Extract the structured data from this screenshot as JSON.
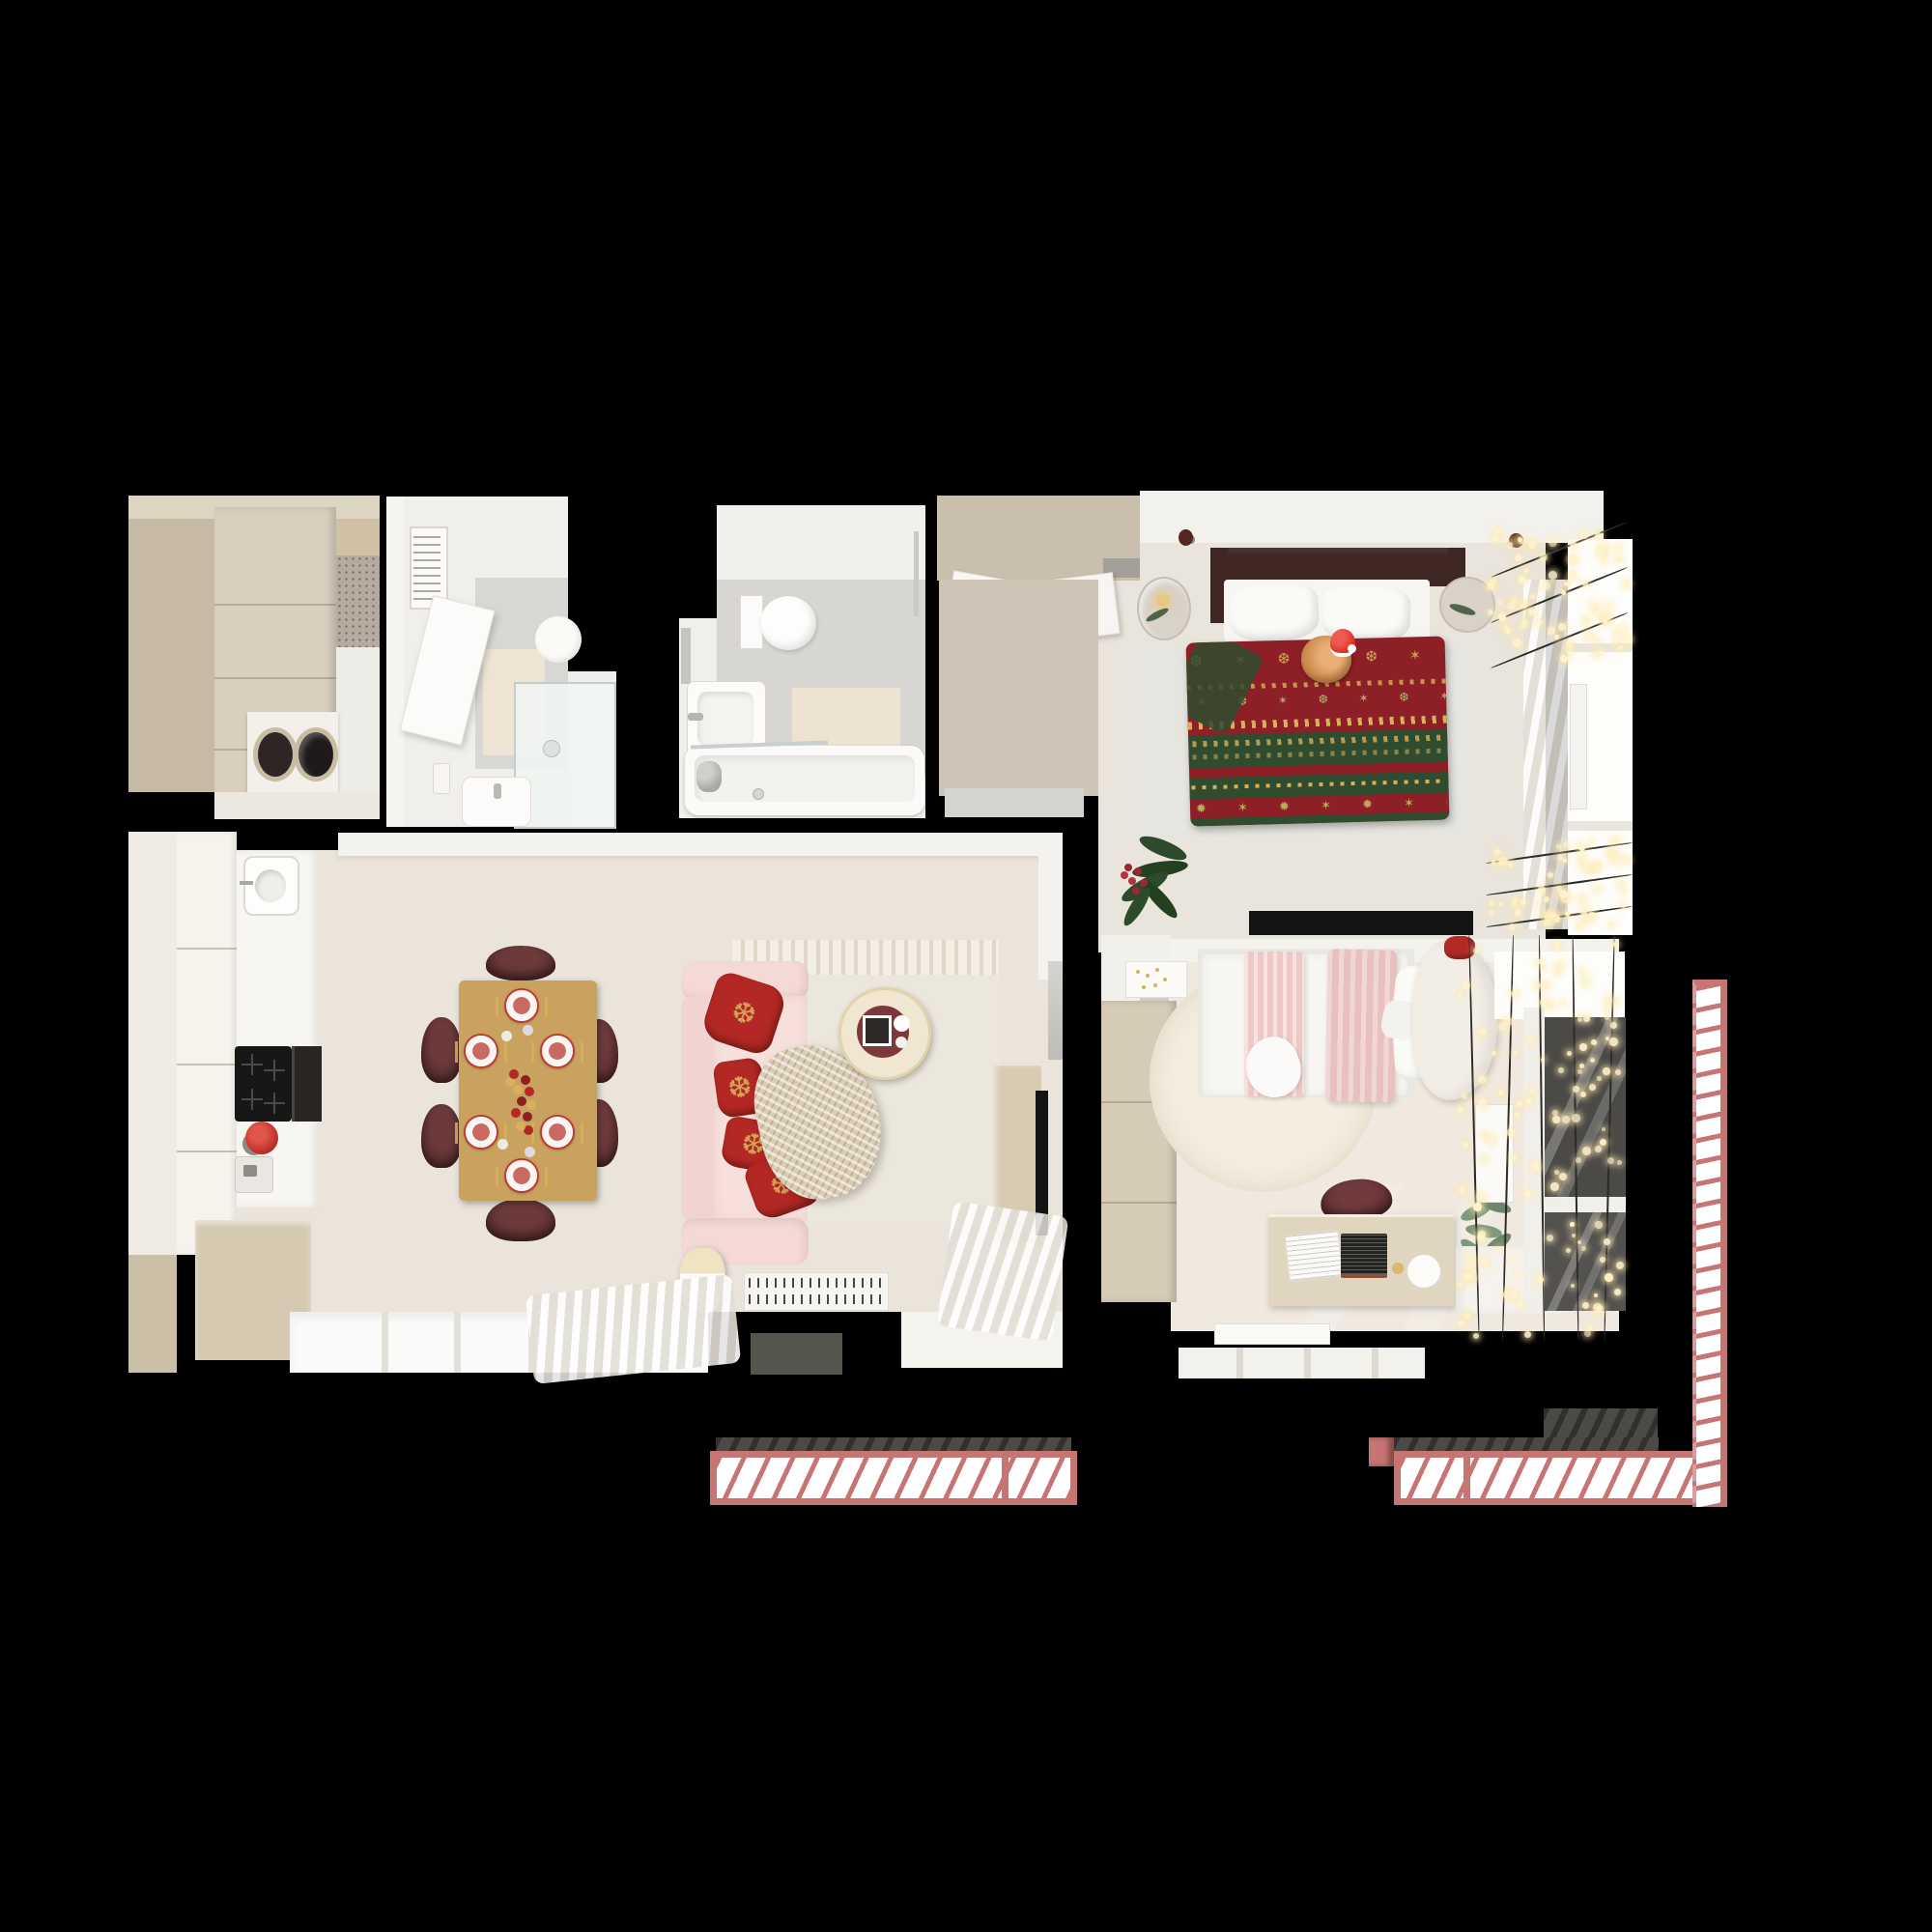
{
  "meta": {
    "description": "Top-down 3D rendered floor plan of a two-bedroom apartment decorated for Christmas",
    "background": "#000000"
  },
  "palette": {
    "bg": "#000000",
    "wood1": "#d2c7b4",
    "wood2": "#c6baa5",
    "wood3": "#dacfbf",
    "woodFloor": "#cfc5b6",
    "woodKBench": "#d5c9b2",
    "woodWardrobe2": "#d6cbb7",
    "woodDesk": "#e0d5bf",
    "woodTV": "#d8cbb2",
    "floorLiving": "#ebe4da",
    "floorBed1": "#e9e4dc",
    "floorBed2": "#f0e9df",
    "wall": "#f4f2ed",
    "white": "#fafaf8",
    "bright": "#fdfdfa",
    "grayTile": "#d8d7d4",
    "grayMat": "#d3d3cf",
    "mosaic": "#b7aba0",
    "matBeige": "#efe4d3",
    "rug1": "#e7e5e0",
    "rug2": "#ece7dc",
    "rug3": "#f4eee1",
    "sofa": "#f4d9d5",
    "sofaLight": "#f7dfdb",
    "pillowRed": "#b32824",
    "gold": "#d8b05a",
    "tableGold": "#c9a25f",
    "chair": "#5c2f30",
    "plateRed": "#c23732",
    "plateFood": "#c96a62",
    "hb": "#3f2823",
    "blkRed": "#8c2026",
    "blkGreen": "#2f4c2f",
    "cat": "#d29052",
    "santa": "#d42b22",
    "glassDark": "#4b4a47",
    "balFloor": "#4b4a47",
    "rail": "#c77573",
    "railDark": "#b55f5f",
    "bulb": "#fff3cf",
    "wire": "#2b2a26",
    "plant1": "#2d4a2b",
    "plant2": "#7f977b",
    "berry": "#9c2733",
    "tv": "#141414",
    "pink1": "#ecc9c6",
    "pink2": "#e8c0bd",
    "cream": "#f2eee6"
  },
  "rooms": [
    {
      "id": "entry-laundry",
      "label": "Entry hall with wardrobe and stacked laundry machines",
      "furniture": [
        "wardrobe",
        "washing-machine",
        "dryer",
        "mosaic-tile-patch"
      ]
    },
    {
      "id": "bathroom-shower",
      "label": "Bathroom with walk-in shower",
      "furniture": [
        "towel-ladder",
        "open-door",
        "glass-shower-cabin",
        "washbasin",
        "round-mirror",
        "bath-mat"
      ]
    },
    {
      "id": "bathroom-tub",
      "label": "Bathroom with bathtub",
      "furniture": [
        "toilet",
        "washbasin",
        "bathtub",
        "glass-screen",
        "bath-mat",
        "shower-rail",
        "mirror"
      ]
    },
    {
      "id": "bedroom-main",
      "label": "Main bedroom with christmas blanket and sleeping cat",
      "furniture": [
        "sliding-wardrobe",
        "doormat",
        "double-bed",
        "fair-isle-christmas-blanket",
        "cat-in-santa-hat",
        "round-nightstand-left",
        "round-nightstand-right",
        "area-rug",
        "potted-plant",
        "tv-sideboard",
        "ceiling-spotlights",
        "window",
        "roman-blind",
        "string-light-garland-top",
        "string-light-garland-bottom"
      ]
    },
    {
      "id": "living-kitchen",
      "label": "Open living room with kitchen and festive dining table",
      "furniture": [
        "tall-cabinets",
        "kitchen-counter",
        "sink",
        "induction-cooktop",
        "built-in-oven",
        "red-kettle",
        "coffee-machine",
        "wood-bench",
        "dining-table",
        "six-dining-chairs",
        "festive-place-settings",
        "ornament-centerpiece",
        "pink-sofa",
        "red-snowflake-pillows",
        "knit-throw",
        "round-coffee-table",
        "cream-rug",
        "radiator",
        "tv-console",
        "tv",
        "floor-lamp",
        "windows",
        "curtains",
        "balcony-door"
      ]
    },
    {
      "id": "bedroom-second",
      "label": "Second bedroom with pink bed and desk",
      "furniture": [
        "wardrobe",
        "mirror-panel",
        "wall-shelf",
        "single-bed",
        "pink-blankets",
        "curved-headboard",
        "round-fluffy-rug",
        "desk",
        "laptop",
        "open-book",
        "desk-lamp",
        "desk-chair",
        "potted-plant",
        "window-sill",
        "vertical-radiator",
        "bottom-radiator",
        "dark-window",
        "string-light-curtain"
      ]
    }
  ],
  "balconies": [
    {
      "id": "balcony-bottom-left",
      "label": "Balcony with pink striped railing"
    },
    {
      "id": "balcony-bottom-right",
      "label": "Wrap-around balcony with pink striped railing"
    },
    {
      "id": "balcony-right-rail",
      "label": "Right side railing run"
    }
  ],
  "decor": {
    "string_light_color": "#fff3cf",
    "garlands_main_bedroom": 2,
    "light_curtain_strands": 5,
    "railing_stripe_color": "#c77573"
  }
}
